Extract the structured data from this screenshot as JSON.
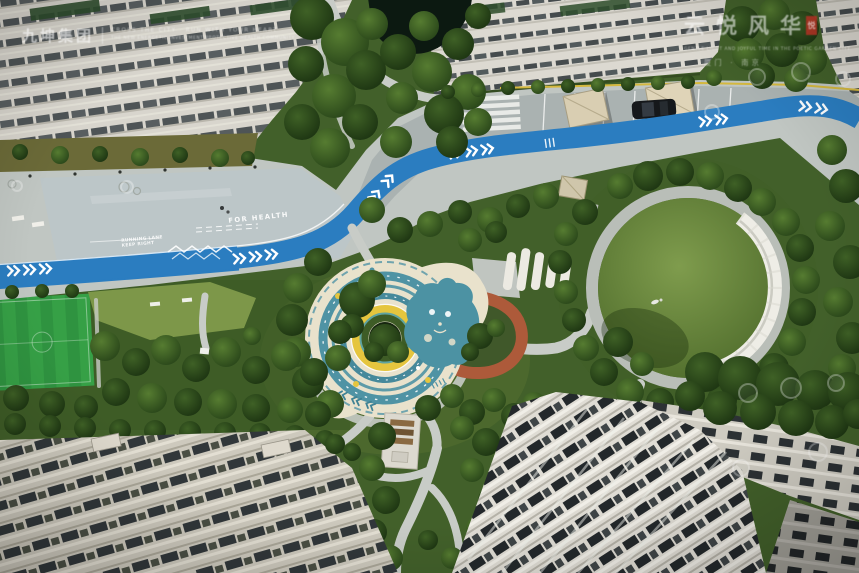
{
  "watermarks": {
    "top_left": {
      "logo": "九坤集团",
      "line1": "CROSS THE CITY · RUN WITH YOUR HEART",
      "line2": "THE NEW ENERGETIC INVESTMENT PROTECTIVE HEALTH COMMUNITY"
    },
    "top_right": {
      "title": "云悦风华",
      "seal": "悦",
      "line1": "GENTLE LIGHT AND JOYFUL TIME IN THE POETIC GARDEN CITY",
      "line2": "厦门 · 南京"
    }
  },
  "ground_markings": {
    "slogan": "FOR HEALTH",
    "label_line1": "RUNNING LANE",
    "label_line2": "KEEP RIGHT"
  },
  "palette": {
    "track_blue": "#2b7dc0",
    "pavement_gray": "#c0c6c2",
    "turf_green": "#36a046",
    "playground_teal": "#4f93a4",
    "playground_yellow": "#e5c53e",
    "playground_cream": "#e9e2cc",
    "terracotta_path": "#ad5a3a",
    "road_yellow_line": "#d4b83e",
    "canopy_beige": "#d9ceb2"
  }
}
